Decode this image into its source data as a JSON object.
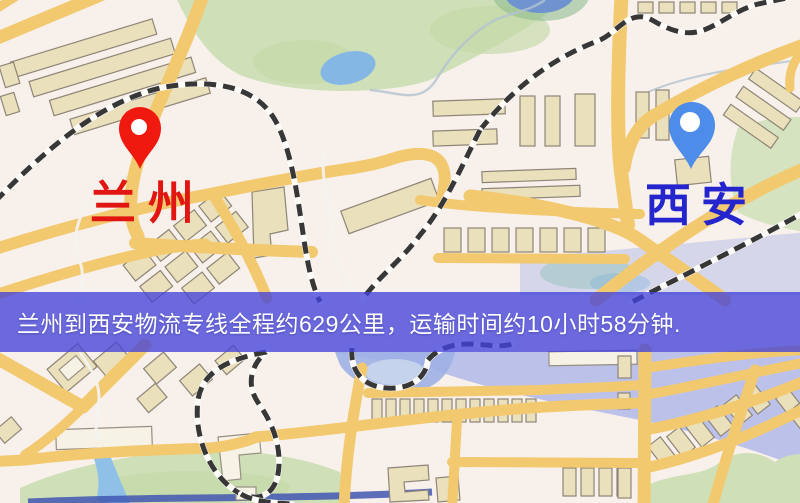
{
  "image": {
    "width": 800,
    "height": 503,
    "kind": "logistics-route-map"
  },
  "banner": {
    "text": "兰州到西安物流专线全程约629公里，运输时间约10小时58分钟.",
    "distance_text": "629公里",
    "duration_text": "10小时58分钟",
    "background_rgba": "rgba(68,66,218,0.78)",
    "text_color": "#ffffff"
  },
  "markers": [
    {
      "city": "兰州",
      "pin_color": "#f0190f",
      "hole_color": "#ffffff",
      "label_color": "#e11511"
    },
    {
      "city": "西安",
      "pin_color": "#4e8ce9",
      "hole_color": "#ffffff",
      "label_color": "#2425cd"
    }
  ],
  "map_palette": {
    "background": "#f8f0eb",
    "road": "#f2c96f",
    "building-fill": "#eae0bc",
    "building-stroke": "#8e8577",
    "building-light": "#f7f2e6",
    "park": "#cfe0b8",
    "water": "#84b7e4",
    "water-lavender": "#adb5ea",
    "railway": "#373737",
    "trail": "#f4f2ef"
  }
}
